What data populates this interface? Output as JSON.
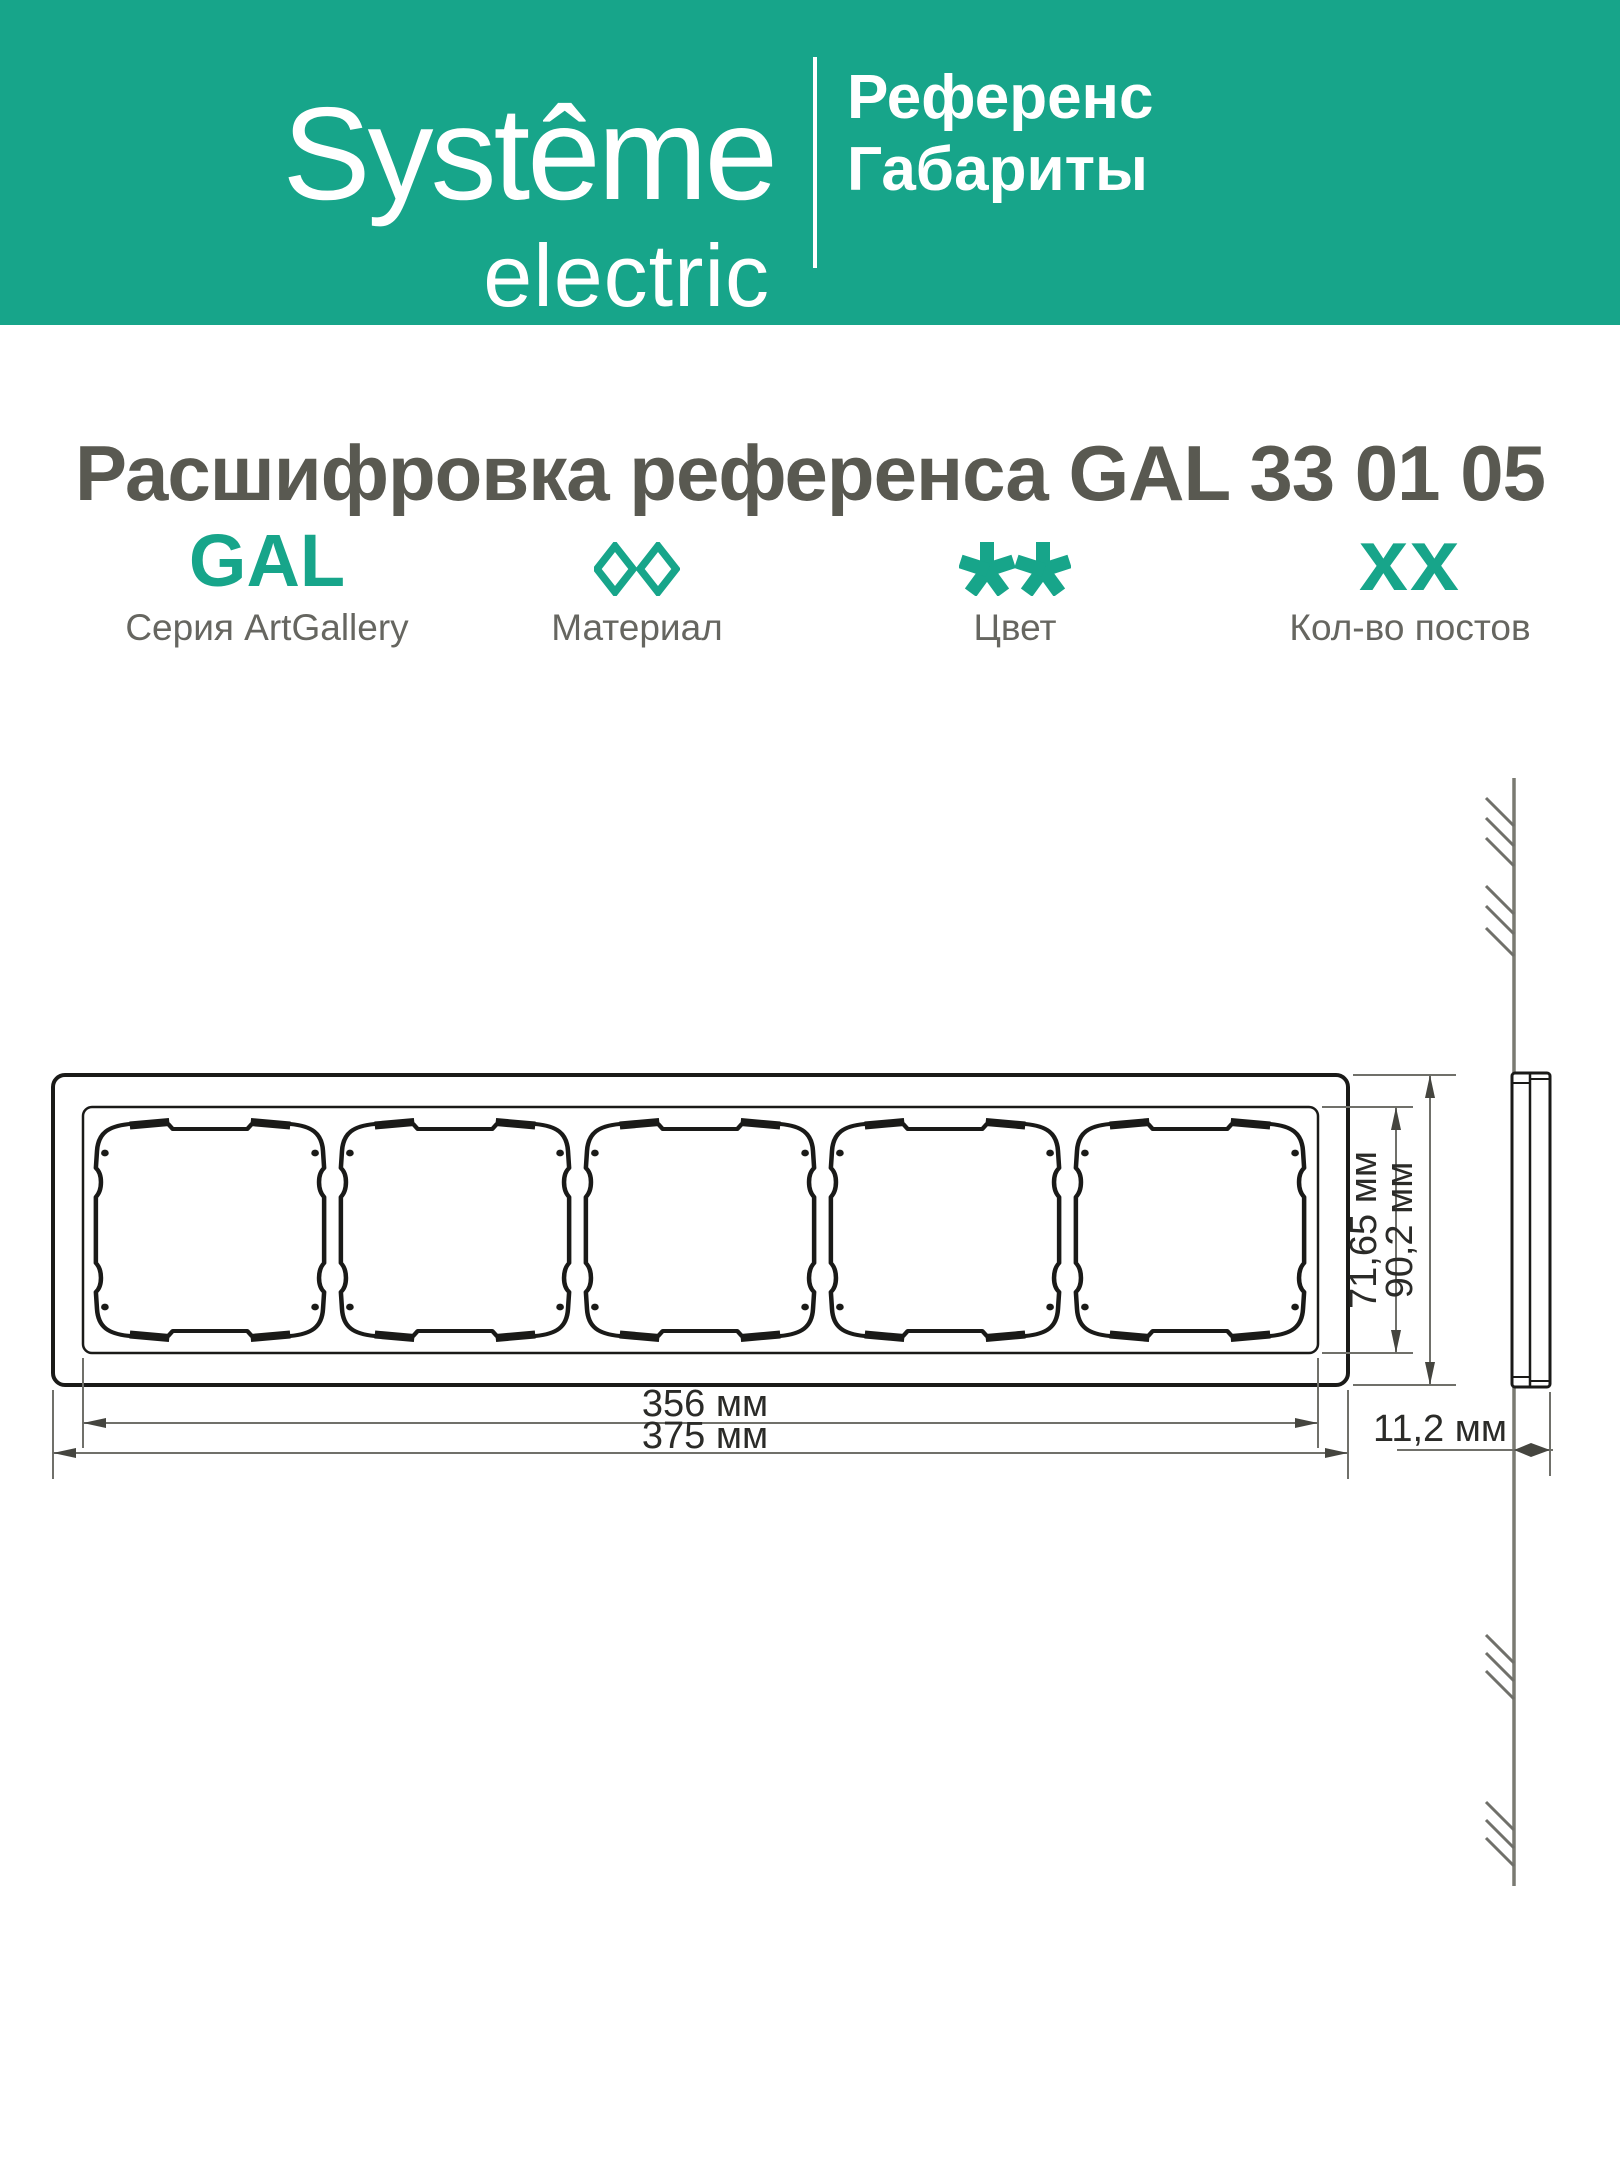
{
  "brand": {
    "name_top": "Systême",
    "name_bottom": "electric"
  },
  "header": {
    "line1": "Референс",
    "line2": "Габариты",
    "bg_color": "#17A58A"
  },
  "title": "Расшифровка референса GAL 33 01 05",
  "reference": {
    "accent_color": "#17A58A",
    "columns": [
      {
        "glyph": "GAL",
        "label": "Серия ArtGallery"
      },
      {
        "glyph": "◊◊",
        "label": "Материал"
      },
      {
        "glyph": "✱✱",
        "label": "Цвет"
      },
      {
        "glyph": "xx",
        "label": "Кол-во постов"
      }
    ]
  },
  "drawing": {
    "posts_count": 5,
    "dimensions": {
      "window_height": "71,65 мм",
      "frame_height": "90,2 мм",
      "windows_span": "356 мм",
      "frame_width": "375 мм",
      "depth": "11,2 мм"
    }
  }
}
